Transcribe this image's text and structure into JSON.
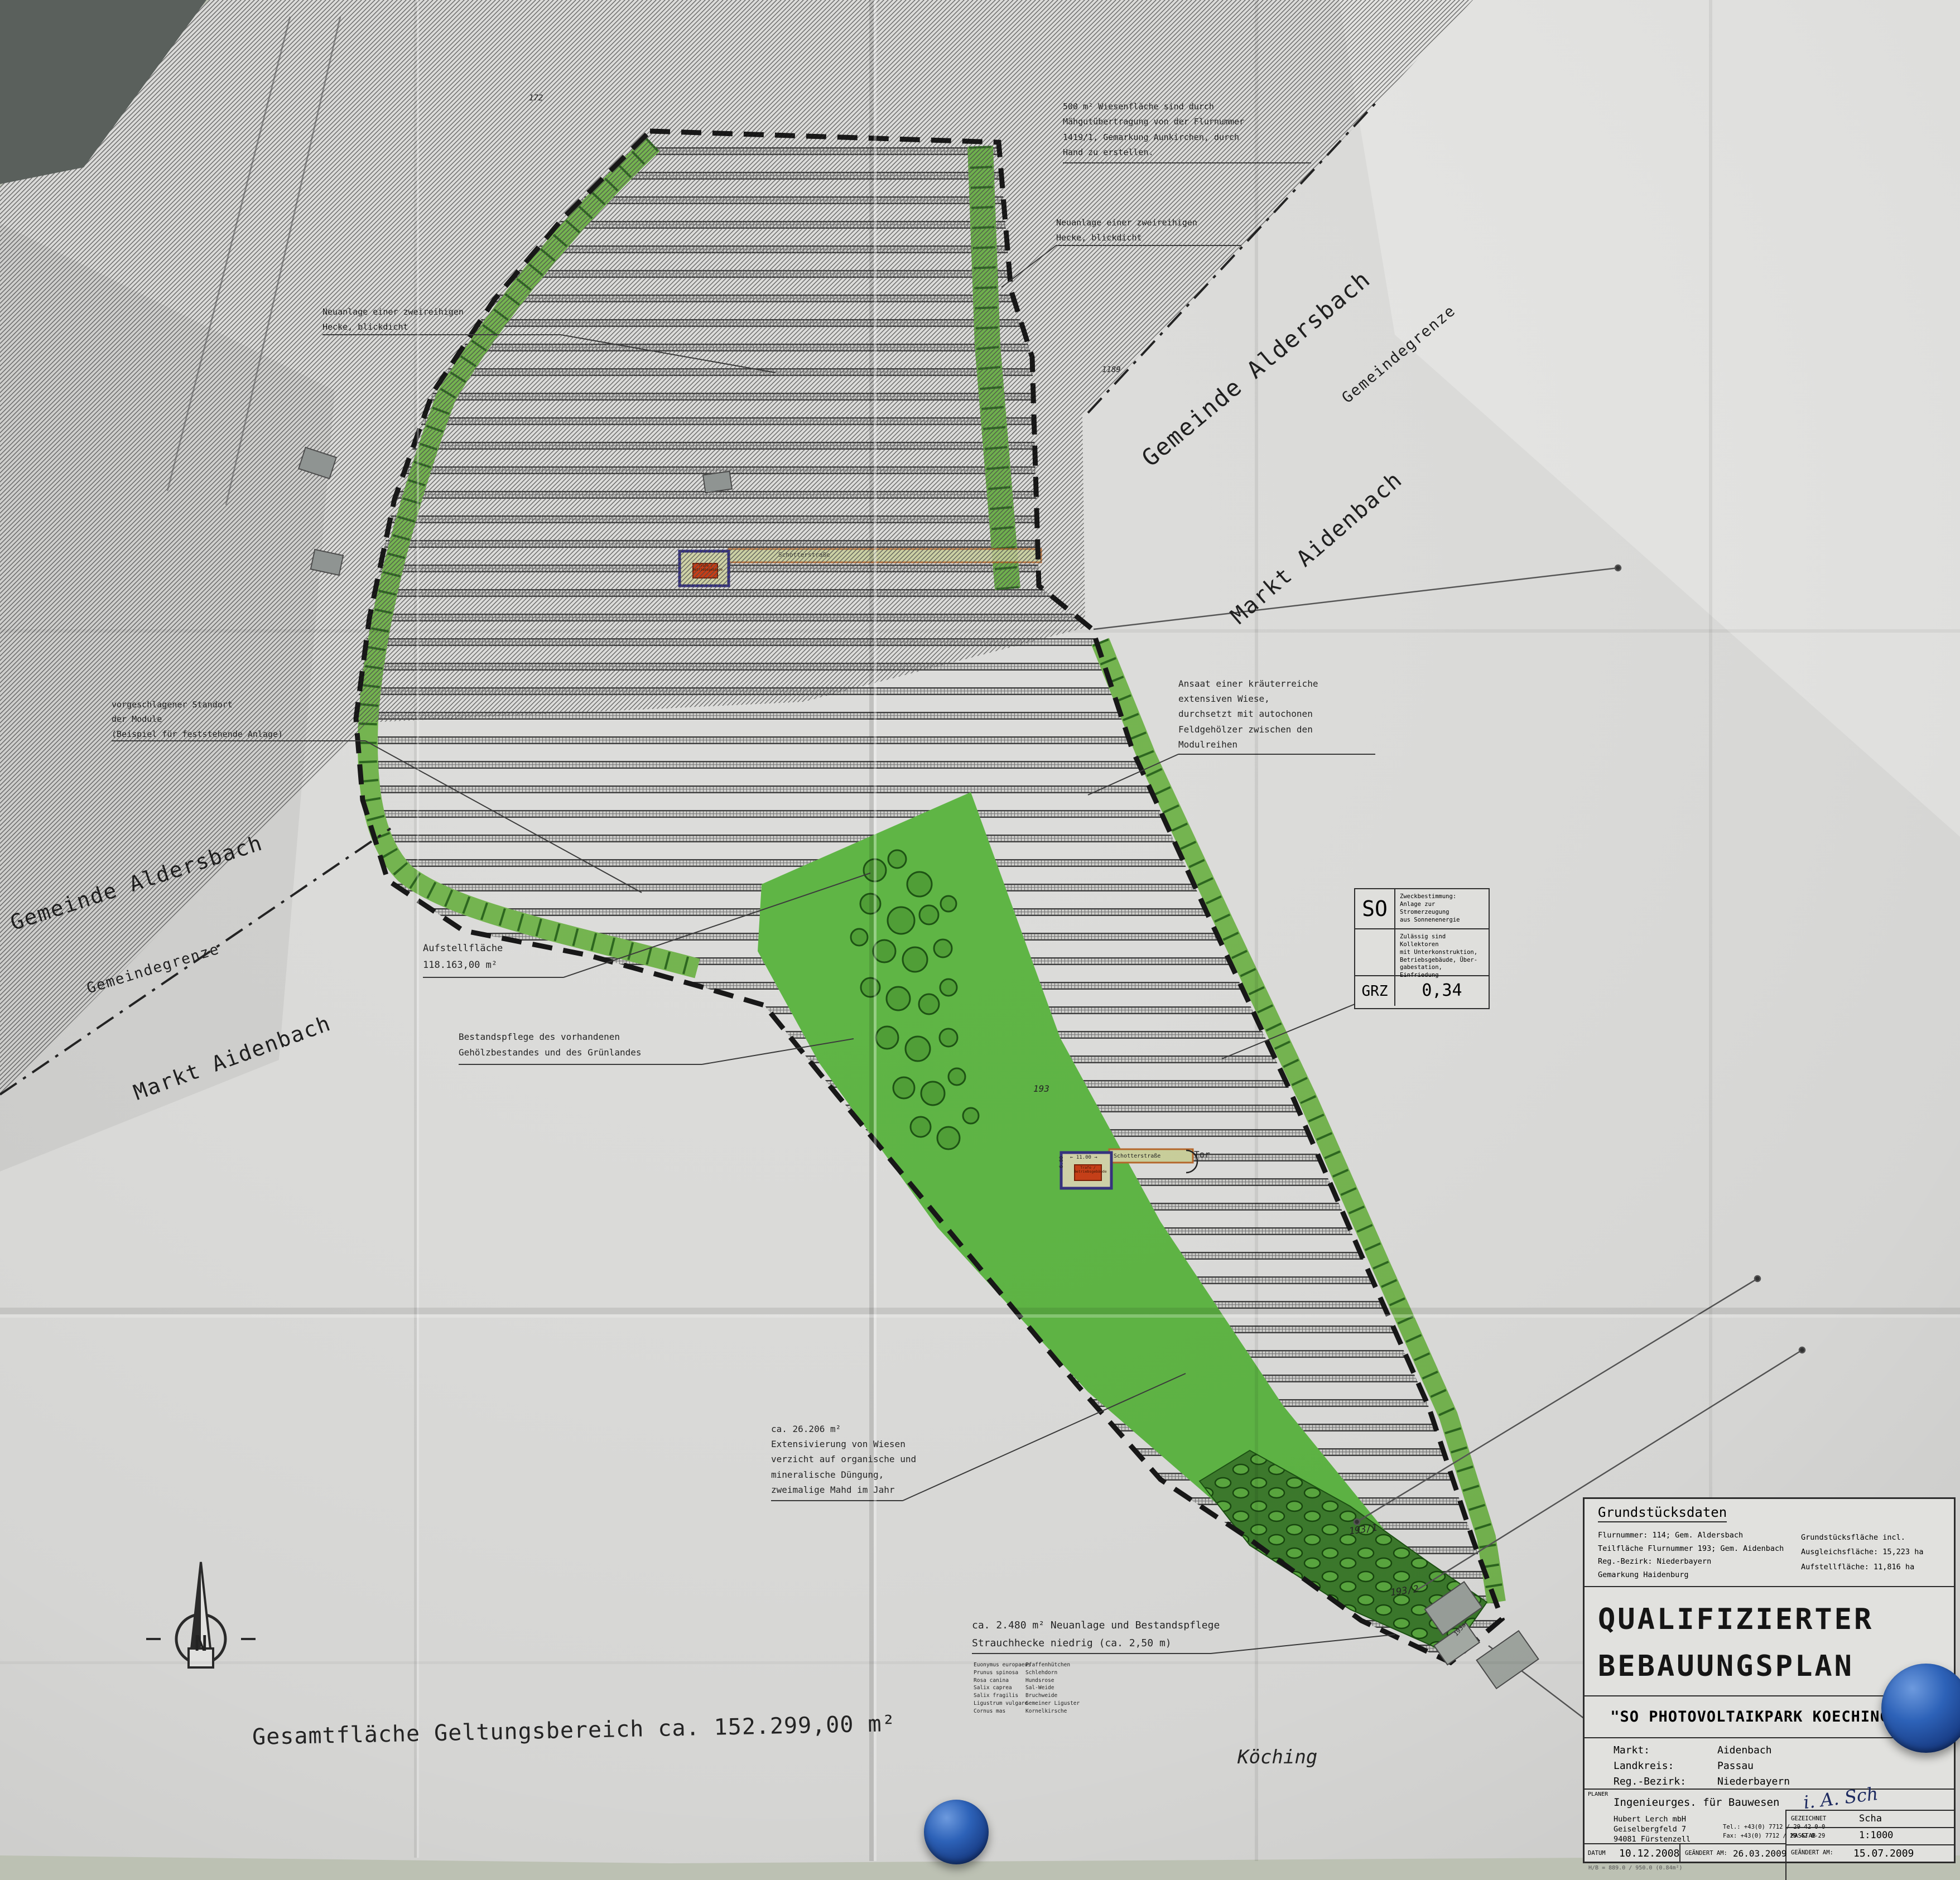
{
  "colors": {
    "paper": "#dcdcda",
    "wall": "#bcc1b3",
    "wall_dark_corner": "#5a605c",
    "hedge_green": "#74b44f",
    "meadow_green": "#5eb544",
    "shrub_dark_green": "#3c7a2c",
    "building_red": "#c63e17",
    "building_border_blue": "#35317e",
    "gravel_road_beige": "#c9cf9b",
    "boundary_black": "#1a1a1a",
    "magnet_blue": "#2d62b8"
  },
  "plan": {
    "boundary_labels": {
      "gemeinde_aldersbach": "Gemeinde Aldersbach",
      "gemeindegrenze": "Gemeindegrenze",
      "markt_aidenbach": "Markt Aidenbach"
    },
    "annotations": {
      "wiesenflaeche": "500 m² Wiesenfläche sind durch\nMähgutübertragung von der Flurnummer\n1419/1, Gemarkung Aunkirchen, durch\nHand zu erstellen.",
      "hecke": "Neuanlage einer zweireihigen\nHecke, blickdicht",
      "standort_module": "vorgeschlagener Standort\nder Module\n(Beispiel für feststehende Anlage)",
      "ansaat": "Ansaat einer kräuterreiche\nextensiven Wiese,\ndurchsetzt mit autochonen\nFeldgehölzer zwischen den\nModulreihen",
      "aufstellflaeche": "Aufstellfläche\n118.163,00 m²",
      "bestandspflege": "Bestandspflege des vorhandenen\nGehölzbestandes und des Grünlandes",
      "extensivierung": "ca. 26.206 m²\nExtensivierung von Wiesen\nverzicht auf organische und\nmineralische Düngung,\nzweimalige Mahd im Jahr",
      "strauchhecke": "ca. 2.480 m² Neuanlage und Bestandspflege\nStrauchhecke niedrig (ca. 2,50 m)",
      "species_latin": "Euonymus europaeus\nPrunus spinosa\nRosa canina\nSalix caprea\nSalix fragilis\nLigustrum vulgare\nCornus mas",
      "species_german": "Pfaffenhütchen\nSchlehdorn\nHundsrose\nSal-Weide\nBruchweide\nGemeiner Liguster\nKornelkirsche",
      "gesamtflaeche": "Gesamtfläche Geltungsbereich ca. 152.299,00 m²"
    },
    "map_labels": {
      "koeching": "Köching",
      "schotterstrasse": "Schotterstraße",
      "tor": "Tor",
      "north": "N",
      "trafo": "Trafo /\nBetriebsgebäude",
      "parcel_172": "172",
      "parcel_1189": "1189",
      "parcel_193": "193",
      "parcel_193_1": "193/1",
      "parcel_193_2": "193/2",
      "parcel_193a": "193a",
      "dim_width": "← 11.00 →",
      "dim_height": "6.00"
    },
    "legend": {
      "so": "SO",
      "zweckbestimmung": "Zweckbestimmung:\nAnlage zur Stromerzeugung\naus Sonnenenergie",
      "zulaessig": "Zulässig sind Kollektoren\nmit Unterkonstruktion,\nBetriebsgebäude, Über-\ngabestation, Einfriedung",
      "grz": "GRZ",
      "grz_value": "0,34"
    }
  },
  "titleblock": {
    "grundstuecksdaten": {
      "title": "Grundstücksdaten",
      "left": "Flurnummer: 114; Gem. Aldersbach\nTeilfläche Flurnummer 193; Gem. Aidenbach\nReg.-Bezirk: Niederbayern\nGemarkung Haidenburg",
      "right": "Grundstücksfläche incl.\nAusgleichsfläche: 15,223 ha\nAufstellfläche:  11,816 ha"
    },
    "main_title": "QUALIFIZIERTER\nBEBAUUNGSPLAN",
    "subtitle": "\"SO PHOTOVOLTAIKPARK KOECHING II\"",
    "region": {
      "labels": "Markt:\nLandkreis:\nReg.-Bezirk:",
      "values": "Aidenbach\nPassau\nNiederbayern"
    },
    "planer": {
      "label": "PLANER",
      "firm": "Ingenieurges. für Bauwesen",
      "address": "Hubert Lerch mbH\nGeiselbergfeld 7\n94081 Fürstenzell",
      "contact": "Tel.: +43(0) 7712 / 29 42 0-0\nFax: +43(0) 7712 / 29 42 0-29",
      "signature": "i. A. Sch"
    },
    "revision": {
      "gezeichnet_label": "GEZEICHNET",
      "gezeichnet": "Scha",
      "masstab_label": "MASSTAB",
      "masstab": "1:1000",
      "geaendert_label": "GEÄNDERT AM:",
      "geaendert": "15.07.2009"
    },
    "dates": {
      "datum_label": "DATUM",
      "datum": "10.12.2008",
      "geaendert_label": "GEÄNDERT AM:",
      "geaendert": "26.03.2009"
    },
    "footnote": "H/B = 889.0 / 950.0 (0.84m²)"
  }
}
